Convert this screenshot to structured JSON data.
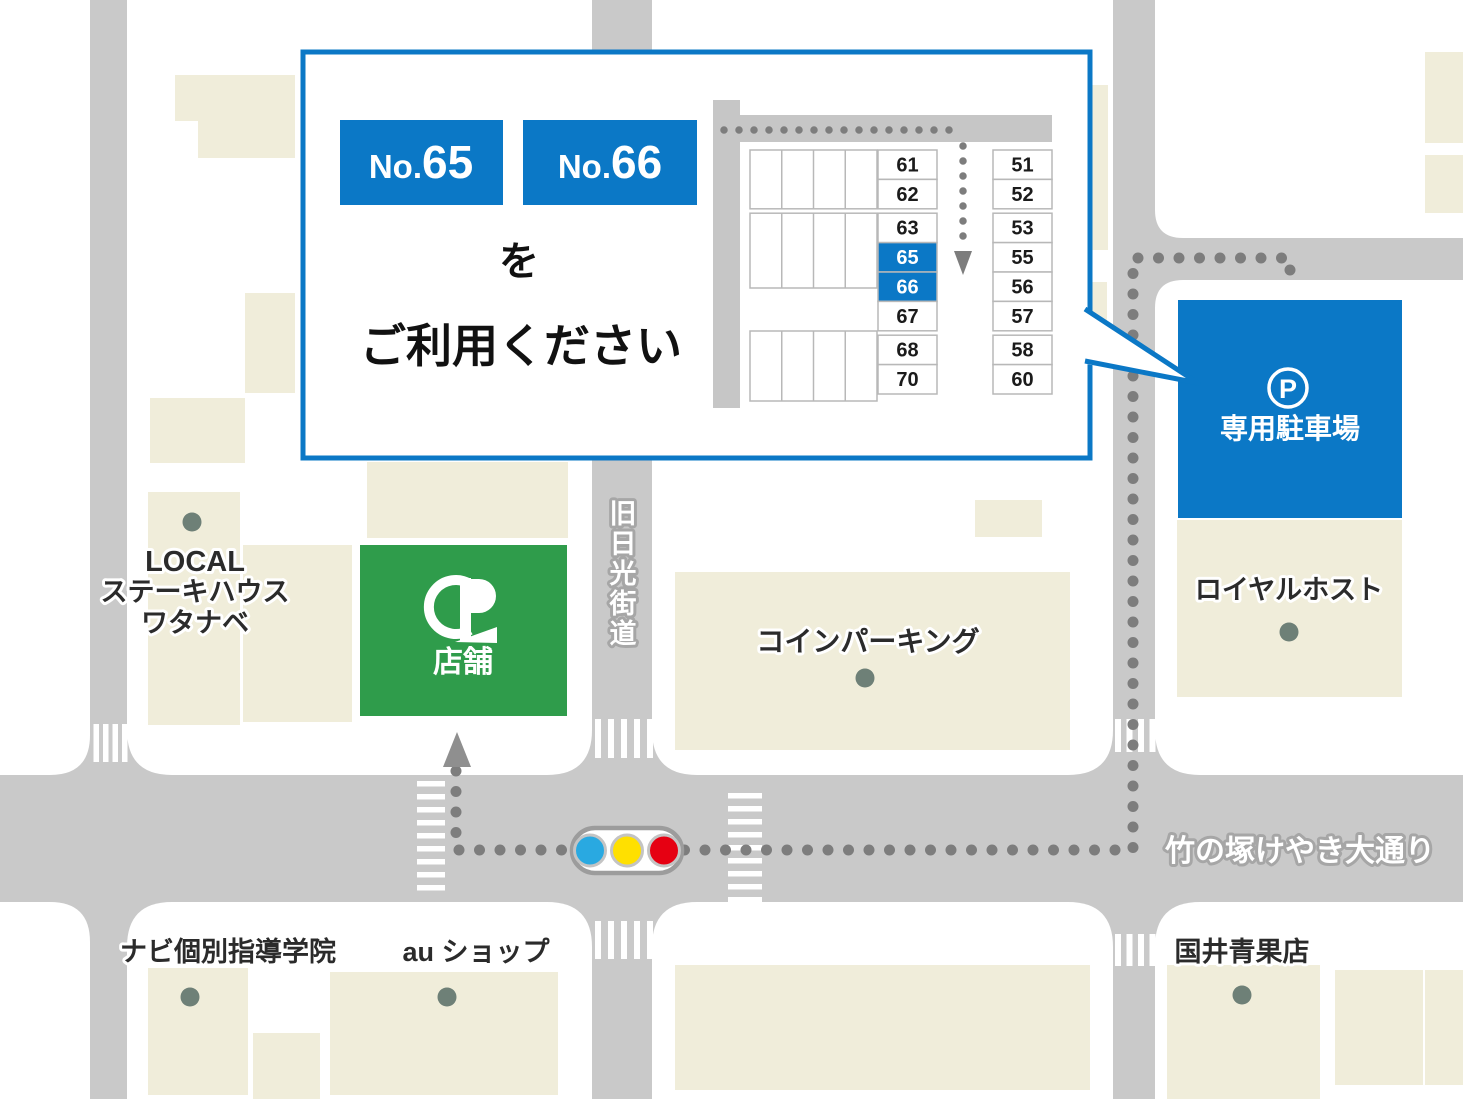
{
  "callout": {
    "badges": [
      {
        "prefix": "No.",
        "number": "65"
      },
      {
        "prefix": "No.",
        "number": "66"
      }
    ],
    "particle": "を",
    "message": "ご利用ください"
  },
  "diagram": {
    "left_spots": [
      "61",
      "62",
      "63",
      "65",
      "66",
      "67",
      "68",
      "70"
    ],
    "right_spots": [
      "51",
      "52",
      "53",
      "55",
      "56",
      "57",
      "58",
      "60"
    ],
    "highlighted_spots": [
      "65",
      "66"
    ]
  },
  "map": {
    "parking_lot": {
      "icon_letter": "P",
      "label": "専用駐車場"
    },
    "store": {
      "label": "店舗",
      "logo": "HP-monogram"
    },
    "roads": {
      "old_nikko": {
        "label": "旧日光街道",
        "chars": [
          "旧",
          "日",
          "光",
          "街",
          "道"
        ]
      },
      "keyaki": {
        "label": "竹の塚けやき大通り"
      }
    },
    "places": {
      "steakhouse": {
        "lines": [
          "LOCAL",
          "ステーキハウス",
          "ワタナベ"
        ]
      },
      "coin_parking": {
        "label": "コインパーキング"
      },
      "royal_host": {
        "label": "ロイヤルホスト"
      },
      "navi_school": {
        "label": "ナビ個別指導学院"
      },
      "au_shop": {
        "label": "au ショップ"
      },
      "kunii_seika": {
        "label": "国井青果店"
      }
    },
    "traffic_light": {
      "colors": [
        "#29a9e1",
        "#ffe000",
        "#e60012"
      ]
    }
  },
  "colors": {
    "accent_blue": "#0b78c6",
    "road_gray": "#c9c9c9",
    "building_beige": "#f0edda",
    "store_green": "#2f9c4b",
    "route_dot_gray": "#7d7d7d",
    "marker_dot": "#6e8077"
  }
}
